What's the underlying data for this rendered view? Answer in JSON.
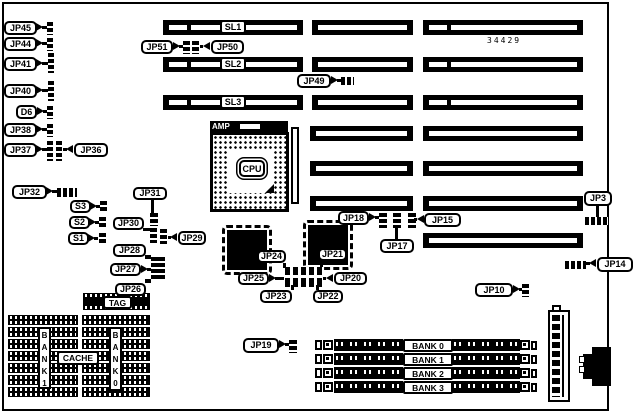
{
  "board": {
    "part_number": "34429",
    "colors": {
      "foreground": "#000000",
      "background": "#ffffff"
    },
    "cpu": {
      "label": "CPU",
      "amp_label": "AMP"
    },
    "cache": {
      "cache_label": "CACHE",
      "tag_label": "TAG",
      "bank_left_vertical": "BANK1",
      "bank_right_vertical": "BANK0"
    },
    "slot_rows": [
      {
        "label": "SL1",
        "label_pos": [
          220,
          20
        ],
        "bars": [
          [
            163,
            20,
            140
          ],
          [
            312,
            20,
            101
          ],
          [
            423,
            20,
            160
          ]
        ]
      },
      {
        "label": "SL2",
        "label_pos": [
          220,
          57
        ],
        "bars": [
          [
            163,
            57,
            140
          ],
          [
            312,
            57,
            101
          ],
          [
            423,
            57,
            160
          ]
        ]
      },
      {
        "label": "SL3",
        "label_pos": [
          220,
          95
        ],
        "bars": [
          [
            163,
            95,
            140
          ],
          [
            312,
            95,
            101
          ],
          [
            423,
            95,
            160
          ]
        ]
      },
      {
        "bars": [
          [
            310,
            126,
            103
          ],
          [
            423,
            126,
            160
          ]
        ]
      },
      {
        "bars": [
          [
            310,
            161,
            103
          ],
          [
            423,
            161,
            160
          ]
        ]
      },
      {
        "bars": [
          [
            310,
            196,
            103
          ],
          [
            423,
            196,
            160
          ]
        ]
      },
      {
        "bars": [
          [
            423,
            233,
            160
          ]
        ]
      }
    ],
    "simm": {
      "labels": [
        "BANK 0",
        "BANK 1",
        "BANK 2",
        "BANK 3"
      ],
      "y0": 339,
      "dy": 14
    },
    "chips": [
      {
        "name": "qfp-chip-left",
        "rect": [
          222,
          225,
          50,
          50
        ]
      },
      {
        "name": "qfp-chip-right",
        "rect": [
          303,
          220,
          50,
          50
        ]
      }
    ],
    "cache_groups": [
      {
        "x": 8,
        "w": 70,
        "rows": 7,
        "y0": 315,
        "dy": 12,
        "h": 10
      },
      {
        "x": 82,
        "w": 68,
        "rows": 7,
        "y0": 315,
        "dy": 12,
        "h": 10
      }
    ],
    "tag_chip": [
      83,
      293,
      67,
      17
    ],
    "callouts": [
      {
        "label": "JP45",
        "box": [
          4,
          21,
          33,
          14
        ],
        "arrow": [
          36,
          23,
          "r"
        ],
        "tails": [
          [
            42,
            26,
            5,
            3
          ]
        ],
        "jumpers": [
          [
            47,
            22,
            6,
            13,
            "v"
          ]
        ]
      },
      {
        "label": "JP44",
        "box": [
          4,
          37,
          33,
          14
        ],
        "arrow": [
          36,
          39,
          "r"
        ],
        "tails": [
          [
            42,
            42,
            5,
            3
          ]
        ],
        "jumpers": [
          [
            47,
            38,
            6,
            13,
            "v"
          ]
        ]
      },
      {
        "label": "JP41",
        "box": [
          4,
          57,
          33,
          14
        ],
        "arrow": [
          36,
          59,
          "r"
        ],
        "tails": [
          [
            42,
            62,
            6,
            3
          ]
        ],
        "jumpers": [
          [
            48,
            53,
            6,
            20,
            "v"
          ]
        ]
      },
      {
        "label": "JP40",
        "box": [
          4,
          84,
          33,
          14
        ],
        "arrow": [
          36,
          86,
          "r"
        ],
        "tails": [
          [
            42,
            89,
            6,
            3
          ]
        ],
        "jumpers": [
          [
            48,
            81,
            6,
            20,
            "v"
          ]
        ]
      },
      {
        "label": "D6",
        "box": [
          16,
          105,
          21,
          14
        ],
        "arrow": [
          37,
          107,
          "r"
        ],
        "tails": [
          [
            43,
            110,
            4,
            3
          ]
        ],
        "jumpers": [
          [
            47,
            106,
            6,
            13,
            "v"
          ]
        ]
      },
      {
        "label": "JP38",
        "box": [
          4,
          123,
          33,
          14
        ],
        "arrow": [
          36,
          125,
          "r"
        ],
        "tails": [
          [
            42,
            128,
            5,
            3
          ]
        ],
        "jumpers": [
          [
            47,
            124,
            6,
            13,
            "v"
          ]
        ]
      },
      {
        "label": "JP37",
        "box": [
          4,
          143,
          33,
          14
        ],
        "arrow": [
          36,
          145,
          "r"
        ],
        "tails": [
          [
            42,
            148,
            5,
            3
          ]
        ],
        "jumpers": [
          [
            47,
            141,
            6,
            20,
            "v"
          ],
          [
            56,
            141,
            6,
            20,
            "v"
          ]
        ]
      },
      {
        "label": "JP36",
        "box": [
          74,
          143,
          34,
          14
        ],
        "arrow": [
          66,
          145,
          "l"
        ],
        "tails": [
          [
            63,
            148,
            4,
            3
          ]
        ],
        "jumpers": []
      },
      {
        "label": "JP32",
        "box": [
          12,
          185,
          35,
          14
        ],
        "arrow": [
          46,
          187,
          "r"
        ],
        "tails": [
          [
            52,
            190,
            5,
            3
          ]
        ],
        "jumpers": [
          [
            57,
            188,
            20,
            9,
            "h"
          ]
        ]
      },
      {
        "label": "S3",
        "box": [
          70,
          200,
          21,
          13
        ],
        "arrow": [
          90,
          202,
          "r"
        ],
        "tails": [
          [
            96,
            205,
            4,
            3
          ]
        ],
        "jumpers": [
          [
            100,
            201,
            7,
            12,
            "v"
          ]
        ]
      },
      {
        "label": "S2",
        "box": [
          69,
          216,
          21,
          13
        ],
        "arrow": [
          89,
          218,
          "r"
        ],
        "tails": [
          [
            95,
            221,
            4,
            3
          ]
        ],
        "jumpers": [
          [
            99,
            217,
            7,
            12,
            "v"
          ]
        ]
      },
      {
        "label": "S1",
        "box": [
          68,
          232,
          21,
          13
        ],
        "arrow": [
          88,
          234,
          "r"
        ],
        "tails": [
          [
            94,
            237,
            4,
            3
          ]
        ],
        "jumpers": [
          [
            99,
            233,
            7,
            12,
            "v"
          ]
        ]
      },
      {
        "label": "JP31",
        "box": [
          133,
          187,
          34,
          13
        ],
        "tails": [
          [
            151,
            200,
            3,
            13
          ]
        ],
        "jumpers": [
          [
            150,
            213,
            8,
            13,
            "v"
          ]
        ]
      },
      {
        "label": "JP30",
        "box": [
          113,
          217,
          31,
          13
        ],
        "tails": [
          [
            143,
            228,
            8,
            3
          ]
        ],
        "jumpers": [
          [
            150,
            228,
            7,
            15,
            "v"
          ],
          [
            160,
            229,
            7,
            15,
            "v"
          ]
        ]
      },
      {
        "label": "JP29",
        "box": [
          178,
          231,
          28,
          14
        ],
        "arrow": [
          170,
          233,
          "l"
        ],
        "tails": [
          [
            168,
            236,
            3,
            3
          ]
        ],
        "jumpers": []
      },
      {
        "label": "JP28",
        "box": [
          113,
          244,
          33,
          13
        ],
        "tails": [
          [
            145,
            255,
            6,
            4
          ]
        ],
        "jumpers": [
          [
            151,
            257,
            14,
            23,
            "v"
          ]
        ]
      },
      {
        "label": "JP27",
        "box": [
          110,
          263,
          31,
          13
        ],
        "arrow": [
          141,
          265,
          "r"
        ],
        "tails": [
          [
            147,
            268,
            4,
            3
          ]
        ],
        "jumpers": []
      },
      {
        "label": "JP26",
        "box": [
          115,
          283,
          31,
          13
        ],
        "tails": [
          [
            145,
            279,
            6,
            4
          ]
        ],
        "jumpers": []
      },
      {
        "label": "JP51",
        "box": [
          141,
          40,
          32,
          14
        ],
        "arrow": [
          173,
          42,
          "r"
        ],
        "tails": [
          [
            179,
            45,
            4,
            3
          ]
        ],
        "jumpers": [
          [
            183,
            41,
            7,
            13,
            "v"
          ],
          [
            192,
            41,
            7,
            13,
            "v"
          ]
        ]
      },
      {
        "label": "JP50",
        "box": [
          211,
          40,
          33,
          14
        ],
        "arrow": [
          203,
          42,
          "l"
        ],
        "tails": [
          [
            200,
            45,
            3,
            3
          ]
        ],
        "jumpers": []
      },
      {
        "label": "JP49",
        "box": [
          297,
          74,
          34,
          14
        ],
        "arrow": [
          331,
          76,
          "r"
        ],
        "tails": [
          [
            337,
            79,
            4,
            3
          ]
        ],
        "jumpers": [
          [
            341,
            77,
            13,
            8,
            "h"
          ]
        ]
      },
      {
        "label": "JP24",
        "box": [
          257,
          250,
          29,
          13
        ],
        "tails": [
          [
            283,
            263,
            3,
            5
          ]
        ],
        "jumpers": []
      },
      {
        "label": "JP21",
        "box": [
          318,
          248,
          29,
          13
        ],
        "tails": [
          [
            320,
            261,
            3,
            6
          ]
        ],
        "jumpers": []
      },
      {
        "label": "JP25",
        "box": [
          238,
          272,
          31,
          13
        ],
        "arrow": [
          269,
          274,
          "r"
        ],
        "tails": [
          [
            275,
            277,
            9,
            3
          ]
        ],
        "jumpers": [
          [
            285,
            267,
            38,
            20,
            "grid"
          ]
        ]
      },
      {
        "label": "JP20",
        "box": [
          334,
          272,
          33,
          13
        ],
        "arrow": [
          326,
          274,
          "l"
        ],
        "tails": [
          [
            323,
            277,
            3,
            3
          ]
        ],
        "jumpers": []
      },
      {
        "label": "JP23",
        "box": [
          260,
          290,
          32,
          13
        ],
        "tails": [
          [
            291,
            285,
            3,
            5
          ]
        ],
        "jumpers": []
      },
      {
        "label": "JP22",
        "box": [
          313,
          290,
          30,
          13
        ],
        "tails": [
          [
            316,
            285,
            3,
            5
          ]
        ],
        "jumpers": []
      },
      {
        "label": "JP18",
        "box": [
          338,
          211,
          31,
          14
        ],
        "arrow": [
          369,
          213,
          "r"
        ],
        "tails": [
          [
            375,
            216,
            4,
            3
          ]
        ],
        "jumpers": [
          [
            379,
            213,
            8,
            15,
            "v"
          ],
          [
            393,
            213,
            8,
            15,
            "v"
          ],
          [
            408,
            213,
            8,
            15,
            "v"
          ]
        ]
      },
      {
        "label": "JP17",
        "box": [
          380,
          239,
          34,
          14
        ],
        "tails": [
          [
            395,
            228,
            3,
            11
          ]
        ],
        "jumpers": []
      },
      {
        "label": "JP15",
        "box": [
          424,
          213,
          37,
          14
        ],
        "arrow": [
          417,
          215,
          "l"
        ],
        "tails": [
          [
            414,
            218,
            3,
            3
          ]
        ],
        "jumpers": []
      },
      {
        "label": "JP3",
        "box": [
          584,
          191,
          28,
          15
        ],
        "tails": [
          [
            596,
            206,
            3,
            11
          ]
        ],
        "jumpers": [
          [
            585,
            217,
            23,
            8,
            "h"
          ]
        ]
      },
      {
        "label": "JP14",
        "box": [
          597,
          257,
          36,
          15
        ],
        "arrow": [
          589,
          259,
          "l"
        ],
        "tails": [
          [
            586,
            262,
            4,
            3
          ]
        ],
        "jumpers": [
          [
            565,
            261,
            21,
            8,
            "h"
          ]
        ]
      },
      {
        "label": "JP10",
        "box": [
          475,
          283,
          38,
          14
        ],
        "arrow": [
          513,
          285,
          "r"
        ],
        "tails": [
          [
            519,
            288,
            3,
            3
          ]
        ],
        "jumpers": [
          [
            522,
            284,
            7,
            13,
            "v"
          ]
        ]
      },
      {
        "label": "JP19",
        "box": [
          243,
          338,
          36,
          15
        ],
        "arrow": [
          279,
          340,
          "r"
        ],
        "tails": [
          [
            285,
            343,
            4,
            3
          ]
        ],
        "jumpers": [
          [
            289,
            340,
            8,
            13,
            "v"
          ]
        ]
      }
    ]
  }
}
